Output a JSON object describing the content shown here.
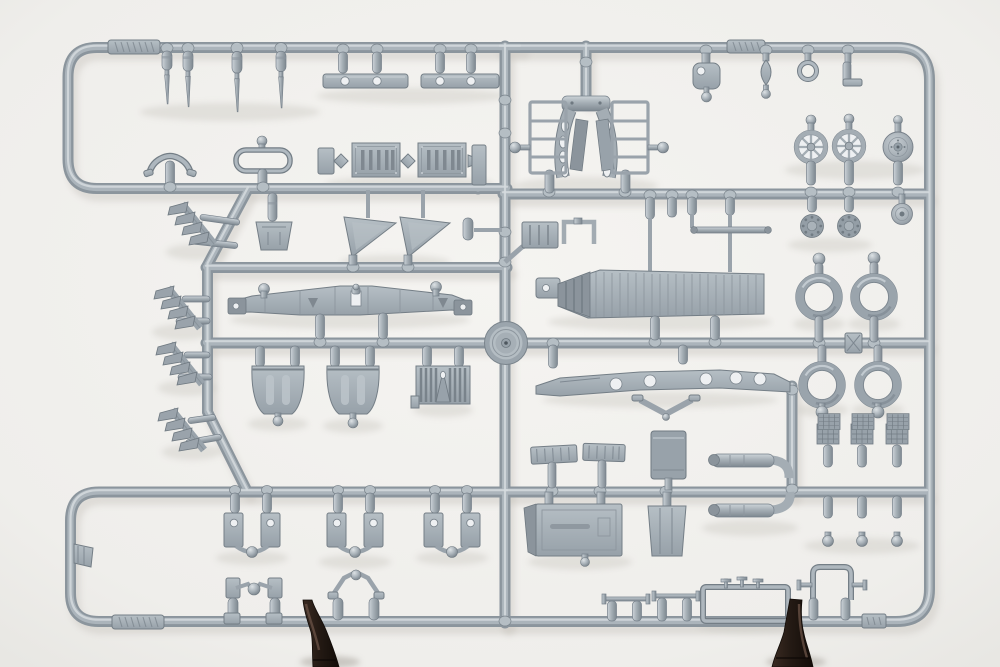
{
  "meta": {
    "type": "photograph",
    "subject": "Light grey injection-moulded plastic model kit sprue (parts frame) photographed on a white studio background, held upright by two dark brown clip stands at its bottom edge",
    "orientation": "landscape"
  },
  "palette": {
    "bg_center": "#f5f4f1",
    "bg_edge": "#e8e7e3",
    "rail_dark": "#8b959d",
    "rail_mid": "#abb4bb",
    "rail_hi": "#d5dbde",
    "part_base": "#a6afb6",
    "part_dark": "#7e8890",
    "part_hi": "#ccd3d8",
    "shadow": "#cfccc6",
    "clamp_dark": "#241a14",
    "clamp_mid": "#3a2b22",
    "clamp_hi": "#6b5347"
  },
  "scene": {
    "frame": "rounded-rectangle sprue frame with internal horizontal runners, one central vertical runner, a zig-zag left runner and a round moulding hub boss at the centre",
    "markings": "illegible embossed maker/part-number cartouches on the top and bottom runners",
    "part_groups": [
      {
        "id": "gun-barrels",
        "label": "tapered gun-barrel / pitot spikes",
        "count": 4
      },
      {
        "id": "spar-bars",
        "label": "flat drilled spar bars",
        "count": 2
      },
      {
        "id": "hook-plate",
        "label": "shackle plate with ball stub",
        "count": 1
      },
      {
        "id": "teardrop",
        "label": "teardrop fairing",
        "count": 1
      },
      {
        "id": "o-ring",
        "label": "open ring part",
        "count": 1
      },
      {
        "id": "l-bracket",
        "label": "L-shaped bracket",
        "count": 1
      },
      {
        "id": "windscreen-arch",
        "label": "curved windscreen arch",
        "count": 1
      },
      {
        "id": "grab-frame",
        "label": "oval grab frame with ball stub",
        "count": 1
      },
      {
        "id": "scoop",
        "label": "trapezoid bucket scoop",
        "count": 1
      },
      {
        "id": "louver-panels",
        "label": "louvred radiator shutters",
        "count": 2
      },
      {
        "id": "gussets",
        "label": "triangular web gussets",
        "count": 2
      },
      {
        "id": "engine-cradle",
        "label": "U-shaped engine bearer cradle with slotted arms",
        "count": 1
      },
      {
        "id": "lattice-frames",
        "label": "ladder lattice side frames with ball stubs",
        "count": 2
      },
      {
        "id": "spoked-wheels",
        "label": "spoked wheels",
        "count": 2
      },
      {
        "id": "disc-wheel",
        "label": "solid disc wheel",
        "count": 1
      },
      {
        "id": "hub-discs",
        "label": "knurled hub discs",
        "count": 2
      },
      {
        "id": "small-wheel",
        "label": "small tail wheel",
        "count": 1
      },
      {
        "id": "push-rod",
        "label": "thin push rod",
        "count": 1
      },
      {
        "id": "corrugated-panel",
        "label": "long corrugated fuselage panel",
        "count": 1
      },
      {
        "id": "centre-spar",
        "label": "bowed wing centre-section spar with ball stubs",
        "count": 1
      },
      {
        "id": "seats",
        "label": "bucket seats with belt reliefs",
        "count": 2
      },
      {
        "id": "ribbed-face",
        "label": "ribbed radiator face with vee splitter",
        "count": 1
      },
      {
        "id": "drilled-strip",
        "label": "bowed strip with lightening holes",
        "count": 1
      },
      {
        "id": "chevron",
        "label": "chevron bracket",
        "count": 1
      },
      {
        "id": "exhausts",
        "label": "fishtail exhaust manifolds",
        "count": 4
      },
      {
        "id": "tyres",
        "label": "ring tyres with ball gates",
        "count": 4
      },
      {
        "id": "axle-plate",
        "label": "cross-ribbed axle plate",
        "count": 1
      },
      {
        "id": "pipes",
        "label": "straight exhaust pipes with elbows",
        "count": 2
      },
      {
        "id": "radiator-cores",
        "label": "waffle radiator core columns",
        "count": 3
      },
      {
        "id": "hatch-panels",
        "label": "ribbed hatch panels",
        "count": 2
      },
      {
        "id": "tank",
        "label": "rectangular fuel tank",
        "count": 1
      },
      {
        "id": "floor-panel",
        "label": "cockpit floor panel with side flap",
        "count": 1
      },
      {
        "id": "side-panel",
        "label": "tapered side panel",
        "count": 1
      },
      {
        "id": "u-mounts",
        "label": "U-shaped engine-mount frames with holes",
        "count": 3
      },
      {
        "id": "linkages",
        "label": "ball-centre control linkages",
        "count": 2
      },
      {
        "id": "tie-rods",
        "label": "tie-rod cylinder pairs",
        "count": 2
      },
      {
        "id": "windshield-frame",
        "label": "open windscreen frame with fittings",
        "count": 1
      },
      {
        "id": "cabane-frame",
        "label": "cabane strut frame",
        "count": 1
      },
      {
        "id": "wedge",
        "label": "small wedge fan part",
        "count": 1
      },
      {
        "id": "stand-clips",
        "label": "dark brown display clips gripping the bottom runner",
        "count": 2
      }
    ]
  }
}
